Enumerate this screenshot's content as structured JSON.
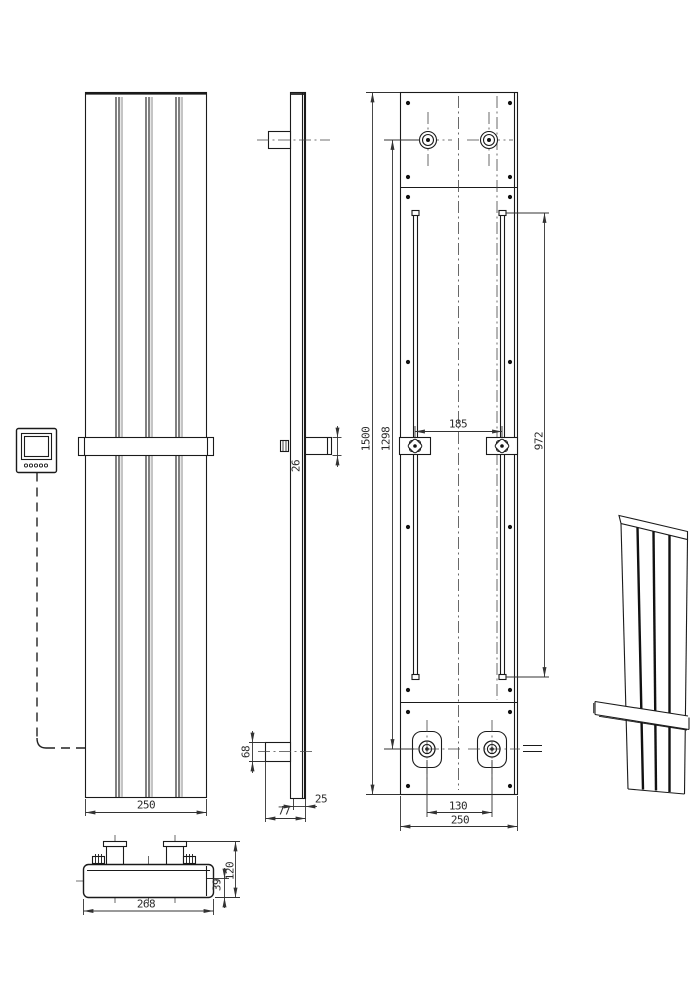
{
  "dims": {
    "front_width": "250",
    "side_bar": "26",
    "side_pipe": "68",
    "side_offset": "25",
    "side_depth": "77",
    "back_height": "1500",
    "back_pipe_height": "1298",
    "back_rail": "972",
    "back_bracket": "185",
    "back_tappings": "130",
    "back_width": "250",
    "top_width": "268",
    "top_depth": "120",
    "top_body": "39"
  },
  "colors": {
    "line": "#1a1a1a",
    "panel_shadow": "#c4c4c4",
    "background": "#ffffff"
  }
}
